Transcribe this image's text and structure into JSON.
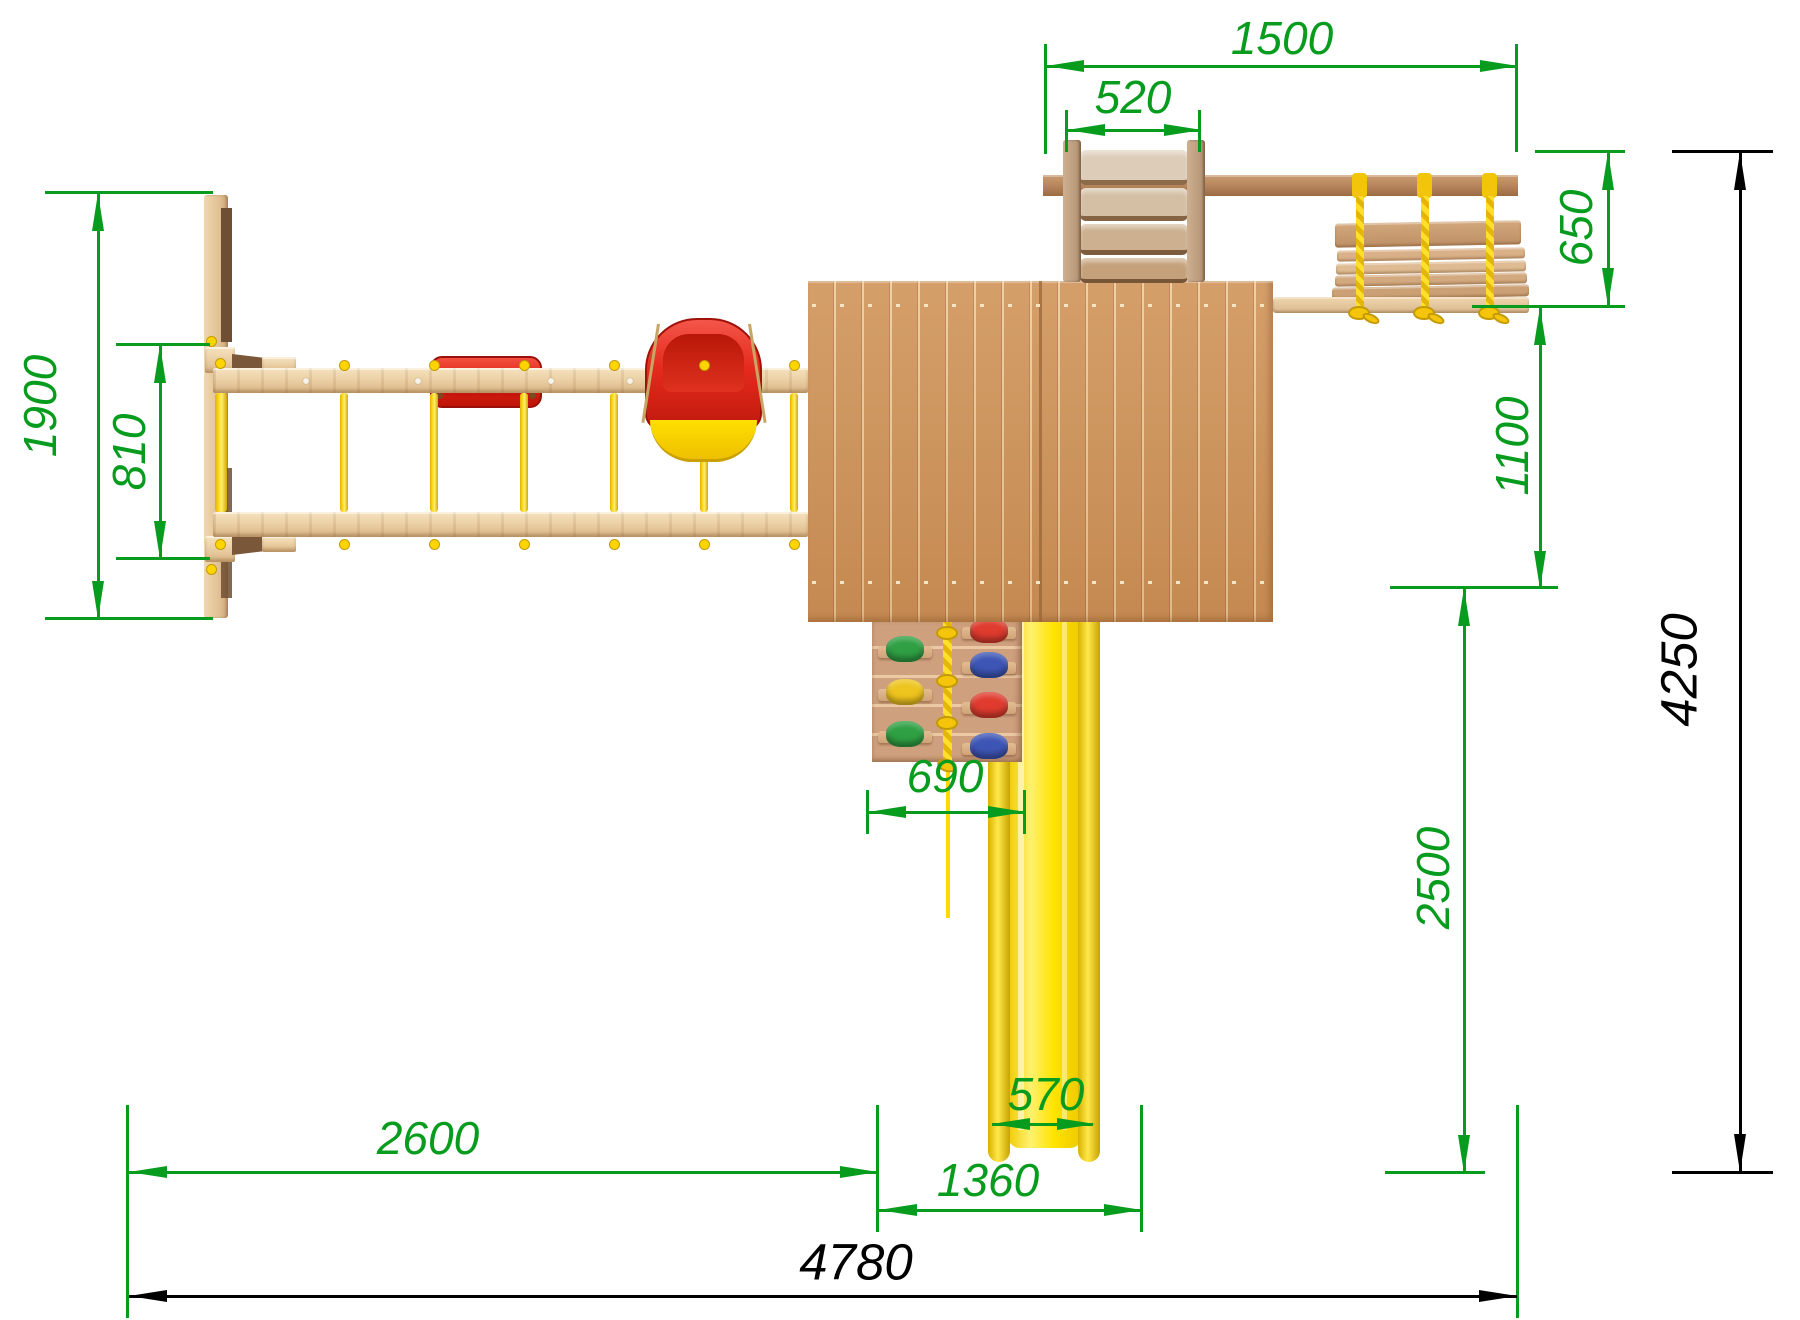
{
  "drawing": {
    "kind": "playground-top-view-dimension-drawing",
    "colors": {
      "dimension_green": "#089c1e",
      "dimension_black": "#000000",
      "wood_light": "#ecd1a6",
      "wood_deck": "#d09459",
      "wood_dark_beam": "#b5835a",
      "plastic_red": "#e42a1c",
      "plastic_yellow": "#ffdd00",
      "hold_green": "#2fa043",
      "hold_blue": "#3d55b5",
      "hold_red": "#df3b2e",
      "hold_yellow": "#eec41e"
    },
    "dims": {
      "d1900": "1900",
      "d810": "810",
      "d1500": "1500",
      "d520": "520",
      "d650": "650",
      "d1100": "1100",
      "d2500": "2500",
      "d690": "690",
      "d570": "570",
      "d2600": "2600",
      "d1360": "1360",
      "d4780": "4780",
      "d4250": "4250"
    }
  }
}
